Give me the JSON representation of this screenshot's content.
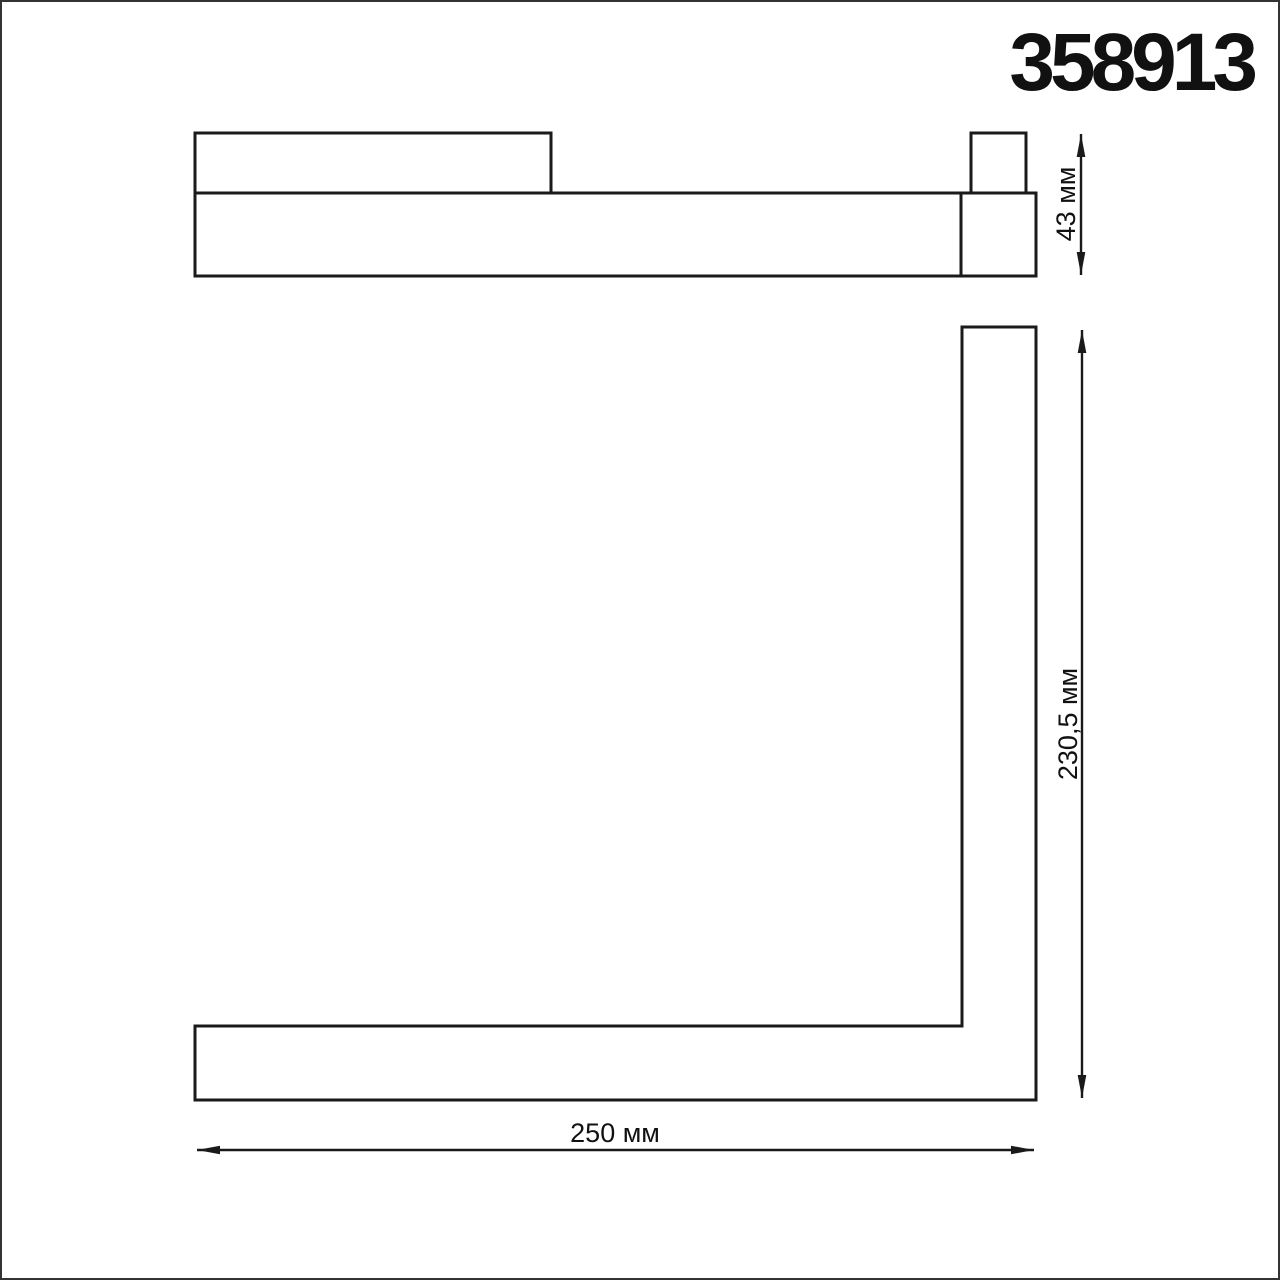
{
  "title": "358913",
  "dimensions": {
    "side_height_label": "43 мм",
    "front_height_label": "230,5 мм",
    "front_width_label": "250 мм"
  },
  "colors": {
    "line": "#1a1a1a",
    "text": "#111111",
    "page_border": "#333333",
    "background": "#ffffff"
  }
}
